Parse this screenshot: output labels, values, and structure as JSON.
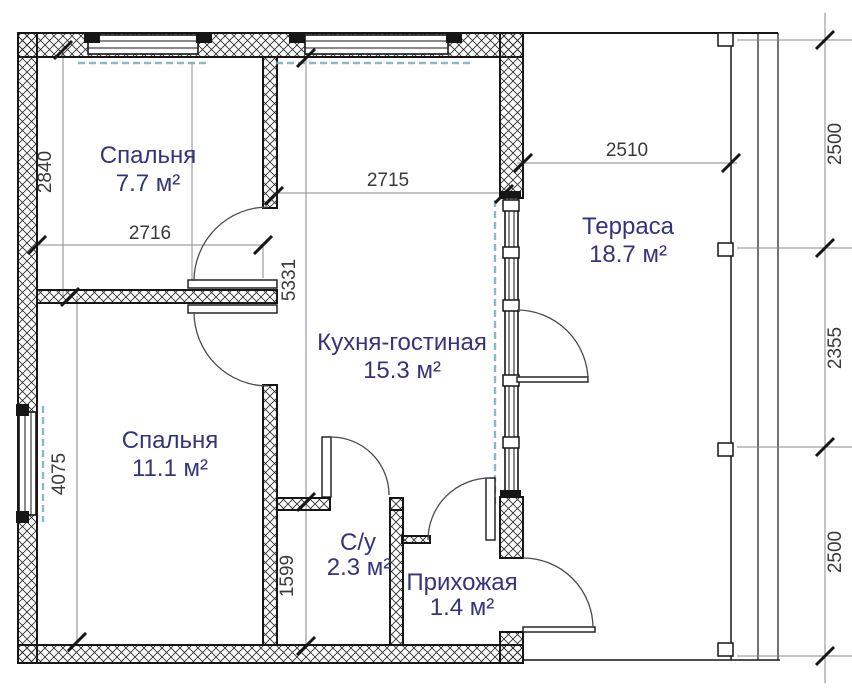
{
  "plan": {
    "rooms": {
      "bedroom1": {
        "name": "Спальня",
        "area": "7.7 м²"
      },
      "bedroom2": {
        "name": "Спальня",
        "area": "11.1 м²"
      },
      "kitchen": {
        "name": "Кухня-гостиная",
        "area": "15.3 м²"
      },
      "terrace": {
        "name": "Терраса",
        "area": "18.7 м²"
      },
      "bathroom": {
        "name": "С/у",
        "area": "2.3 м²"
      },
      "hallway": {
        "name": "Прихожая",
        "area": "1.4 м²"
      }
    },
    "dimensions": {
      "bedroom1_width": "2716",
      "bedroom1_height": "2840",
      "bedroom2_height": "4075",
      "kitchen_width": "2715",
      "kitchen_length": "5331",
      "bathroom_height": "1599",
      "terrace_width": "2510",
      "terrace_right_top": "2500",
      "terrace_right_middle": "2355",
      "terrace_right_bottom": "2500"
    },
    "colors": {
      "label": "#34347c",
      "dim": "#3a3a3a",
      "line": "#161616",
      "curtain": "#76aebc"
    }
  }
}
